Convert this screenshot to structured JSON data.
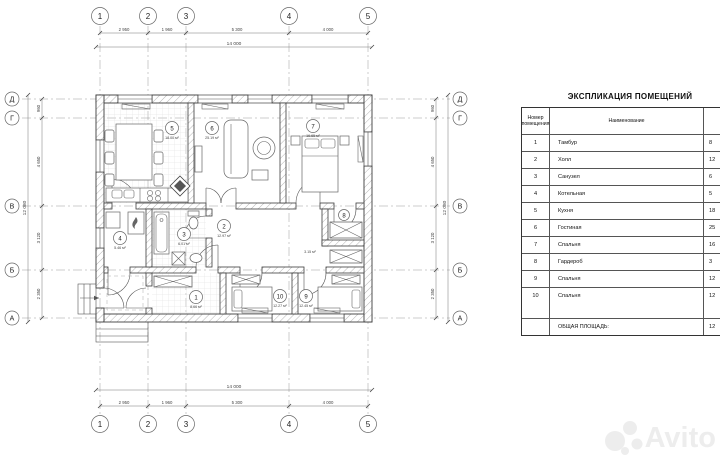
{
  "plan": {
    "axes_h": [
      "1",
      "2",
      "3",
      "4",
      "5"
    ],
    "axes_v": [
      "Д",
      "Г",
      "В",
      "Б",
      "А"
    ],
    "dims_top": [
      "2 950",
      "1 960",
      "5 300",
      "4 000"
    ],
    "dims_top_total": "14 000",
    "dims_bottom": [
      "2 950",
      "1 960",
      "5 300",
      "4 000"
    ],
    "dims_bottom_total": "14 000",
    "dims_left": [
      "960",
      "4 650",
      "3 120",
      "2 350"
    ],
    "dims_left_total": "12 080",
    "dims_right": [
      "960",
      "4 650",
      "3 120",
      "2 350"
    ],
    "dims_right_total": "12 080",
    "rooms": [
      {
        "number": "1",
        "area": "8.66 м²"
      },
      {
        "number": "2",
        "area": "12.97 м²"
      },
      {
        "number": "3",
        "area": "6.01 м²"
      },
      {
        "number": "4",
        "area": "5.46 м²"
      },
      {
        "number": "5",
        "area": "18.00 м²"
      },
      {
        "number": "6",
        "area": "25.19 м²"
      },
      {
        "number": "7",
        "area": "16.65 м²"
      },
      {
        "number": "8",
        "area": "3.15 м²"
      },
      {
        "number": "9",
        "area": "12.45 м²"
      },
      {
        "number": "10",
        "area": "12.27 м²"
      }
    ]
  },
  "table": {
    "title": "ЭКСПЛИКАЦИЯ ПОМЕЩЕНИЙ",
    "columns": {
      "number_line1": "Номер",
      "number_line2": "помещения",
      "name": "Наименование",
      "area": "Площадь"
    },
    "rows": [
      {
        "number": "1",
        "name": "Тамбур",
        "area": "8"
      },
      {
        "number": "2",
        "name": "Холл",
        "area": "12"
      },
      {
        "number": "3",
        "name": "Санузел",
        "area": "6"
      },
      {
        "number": "4",
        "name": "Котельная",
        "area": "5"
      },
      {
        "number": "5",
        "name": "Кухня",
        "area": "18"
      },
      {
        "number": "6",
        "name": "Гостиная",
        "area": "25"
      },
      {
        "number": "7",
        "name": "Спальня",
        "area": "16"
      },
      {
        "number": "8",
        "name": "Гардероб",
        "area": "3"
      },
      {
        "number": "9",
        "name": "Спальня",
        "area": "12"
      },
      {
        "number": "10",
        "name": "Спальня",
        "area": "12"
      }
    ],
    "total_label": "ОБЩАЯ ПЛОЩАДЬ:",
    "total_area": "12"
  },
  "watermark": {
    "text": "Avito"
  }
}
